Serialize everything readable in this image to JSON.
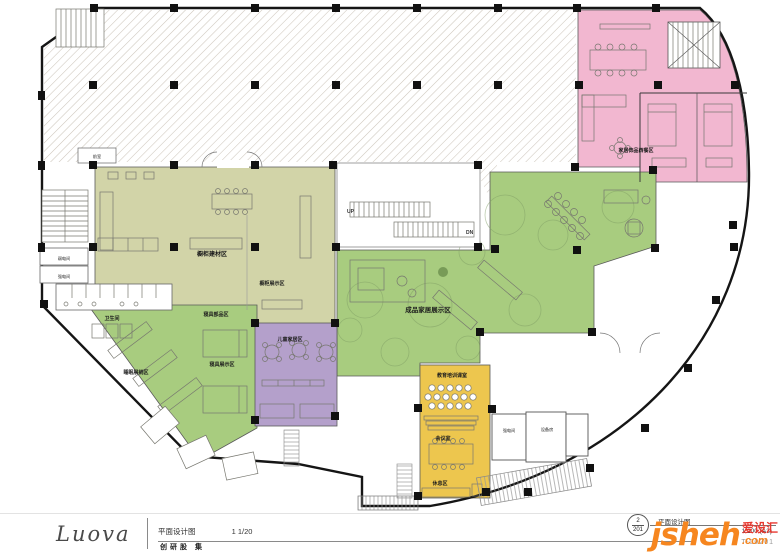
{
  "plan": {
    "labels": {
      "up": "UP",
      "dn": "DN",
      "front_room": "前室",
      "home_dining": "家居饰品西餐区",
      "cabinet_materials": "橱柜建材区",
      "cabinet_display": "橱柜展示区",
      "weak_power": "弱电间",
      "strong_power": "强电间",
      "restroom": "卫生间",
      "bedding_parts": "寝具部品区",
      "bedding_display": "寝具展示区",
      "sleep_display": "睡眠展销区",
      "kids_home": "儿童家居区",
      "finished_home": "成品家居展示区",
      "training_room": "教育培训课室",
      "meeting_room": "会议室",
      "rest_area": "休息区",
      "strong_power2": "强电间",
      "equipment_room": "设备房"
    },
    "zone_colors": {
      "pink": "#f2b7d0",
      "olive": "#d2d4a8",
      "green": "#a8cc7f",
      "purple": "#b4a0cb",
      "yellow": "#edc64e"
    }
  },
  "titlebar": {
    "left": {
      "logo": "Luova",
      "drawing_name": "平面设计图",
      "scale": "1 1/20",
      "subtitle": "创研股 集"
    },
    "right": {
      "sheet_top": "2",
      "sheet_bottom": "201",
      "drawing_name": "平面设计图",
      "scale": "1:200 (A3)",
      "doc_no": "T-00201"
    }
  },
  "watermark": {
    "name": "jsheh",
    "suffix": ".com",
    "cn": "爱设汇",
    "orange": "#f6861f",
    "red": "#e8382f"
  }
}
